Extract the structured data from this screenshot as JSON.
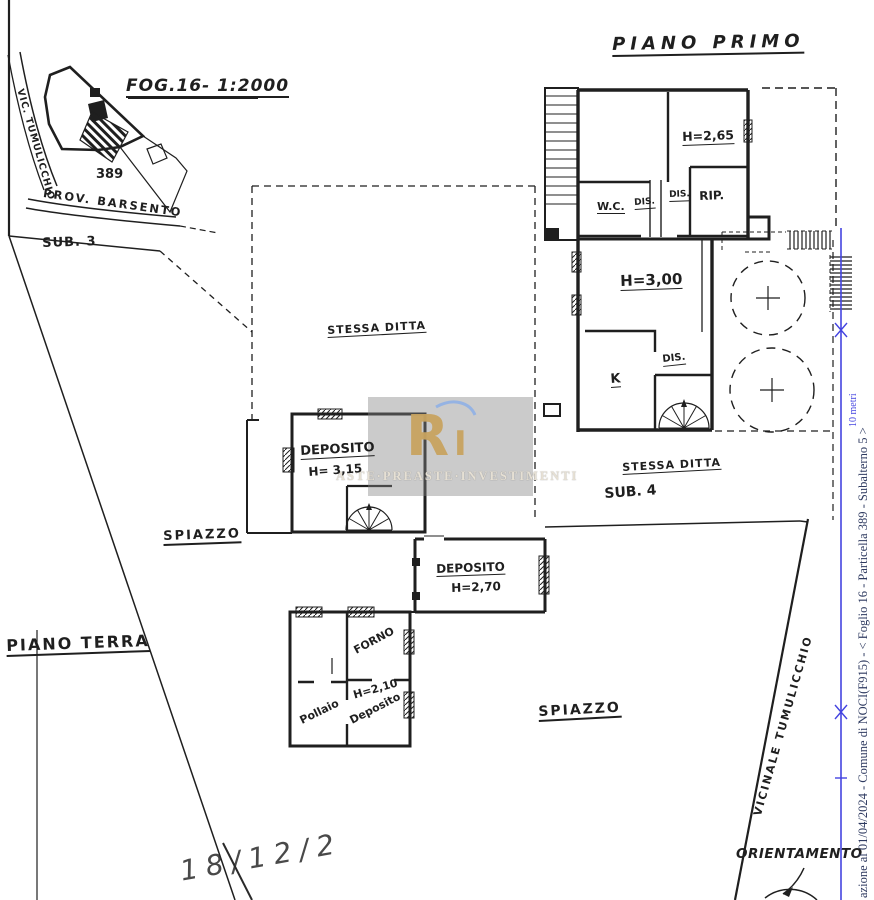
{
  "theme": {
    "ink": "#1f1f1f",
    "paper": "#ffffff",
    "blue": "#4444e0",
    "caption_color": "#2e3a60",
    "wm_bg": "rgba(132,132,132,0.42)",
    "wm_gold": "#c8a360",
    "wm_blue": "#8fb0e6",
    "wm_text": "#e6e0d4"
  },
  "inset": {
    "title": "FOG.16- 1:2000",
    "road_left": "VIC. TUMULICCHIO",
    "parcel": "389",
    "road_bottom": "PROV. BARSENTO"
  },
  "labels": {
    "sub3": "SUB. 3"
  },
  "floor1": {
    "title": "PIANO PRIMO",
    "rooms": {
      "h265": "H=2,65",
      "wc": "W.C.",
      "dis1": "DIS.",
      "dis2": "DIS.",
      "rip": "RIP.",
      "h300": "H=3,00",
      "dis3": "DIS.",
      "k": "K"
    }
  },
  "center": {
    "stessa_ditta": "STESSA DITTA"
  },
  "dep315": {
    "name": "DEPOSITO",
    "height": "H= 3,15"
  },
  "sub4": {
    "stessa_ditta": "STESSA DITTA",
    "label": "SUB. 4"
  },
  "dep270": {
    "name": "DEPOSITO",
    "height": "H=2,70"
  },
  "ground": {
    "spiazzo_left": "SPIAZZO",
    "piano_terra": "PIANO TERRA",
    "spiazzo_bottom": "SPIAZZO"
  },
  "outbuilding": {
    "forno": "FORNO",
    "h210": "H=2,10",
    "deposito": "Deposito",
    "pollaio": "Pollaio"
  },
  "road": {
    "label": "VICINALE TUMULICCHIO"
  },
  "compass": {
    "label": "ORIENTAMENTO"
  },
  "bottom": {
    "handwriting": "18/12/2"
  },
  "sidebar": {
    "caption": "azione al 01/04/2024 - Comune di NOCI(F915) - <  Foglio 16 - Particella  389 - Subalterno 5 >",
    "scale_label": "10 metri"
  },
  "watermark": {
    "monogram": "R",
    "monogram_i": "I",
    "text": "ASTE·PREASTE·INVESTIMENTI"
  }
}
